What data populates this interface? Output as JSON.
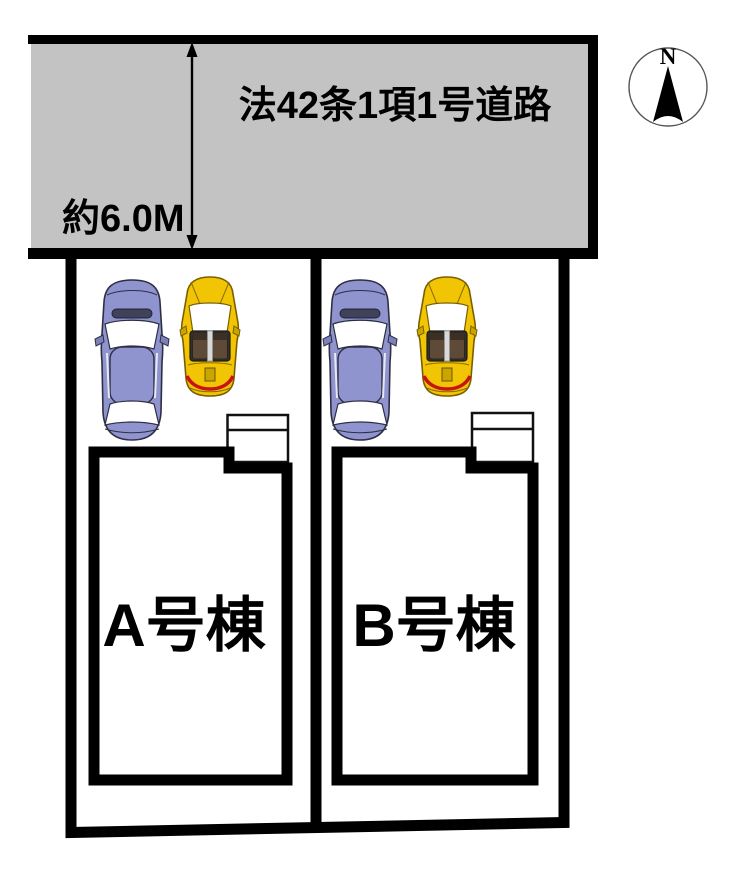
{
  "road": {
    "label": "法42条1項1号道路",
    "width_label": "約6.0M"
  },
  "compass": {
    "north_label": "N"
  },
  "lots": [
    {
      "building_label": "A号棟"
    },
    {
      "building_label": "B号棟"
    }
  ],
  "colors": {
    "road_gray": "#c3c3c3",
    "line_black": "#000000",
    "car_blue": "#8f94cf",
    "car_yellow": "#f2c504",
    "car_red_accent": "#c81414"
  }
}
